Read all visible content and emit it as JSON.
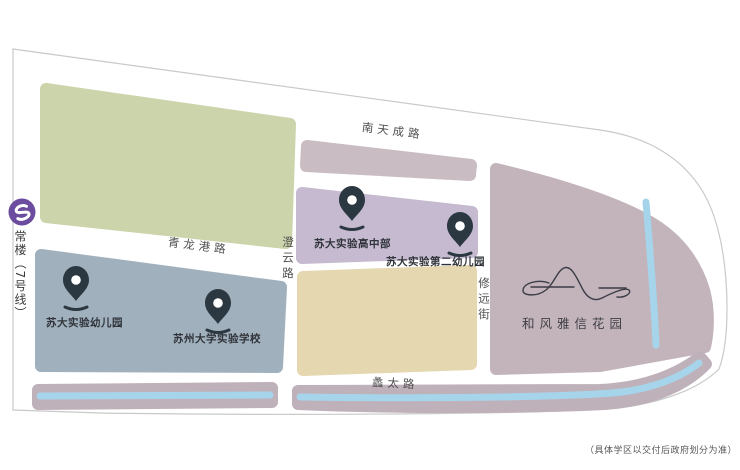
{
  "map": {
    "roads": {
      "top": "南天成路",
      "qinglonggang": "青龙港路",
      "chengyun": "澄云路",
      "xiuyuan": "修远街",
      "litai": "蠡太路"
    },
    "metro": {
      "station": "常楼（7号线）"
    },
    "schools": [
      {
        "name": "苏大实验幼儿园"
      },
      {
        "name": "苏州大学实验学校"
      },
      {
        "name": "苏大实验高中部"
      },
      {
        "name": "苏大实验第二幼儿园"
      }
    ],
    "project": {
      "name": "和风雅信花园"
    },
    "disclaimer": "（具体学区以交付后政府划分为准）",
    "colors": {
      "outline": "#c9c9c9",
      "green_block": "#ccd4ab",
      "bluegray_block": "#a0b0bd",
      "mauve_block": "#c9bcc2",
      "purple_block": "#c5bad0",
      "tan_block": "#e5d7af",
      "right_block": "#c3b4bc",
      "strip_block": "#bfb1ba",
      "river": "#a6d4ea",
      "pin": "#2c3841",
      "metro": "#6b4c9f",
      "logo_line": "#3c3c46"
    }
  }
}
